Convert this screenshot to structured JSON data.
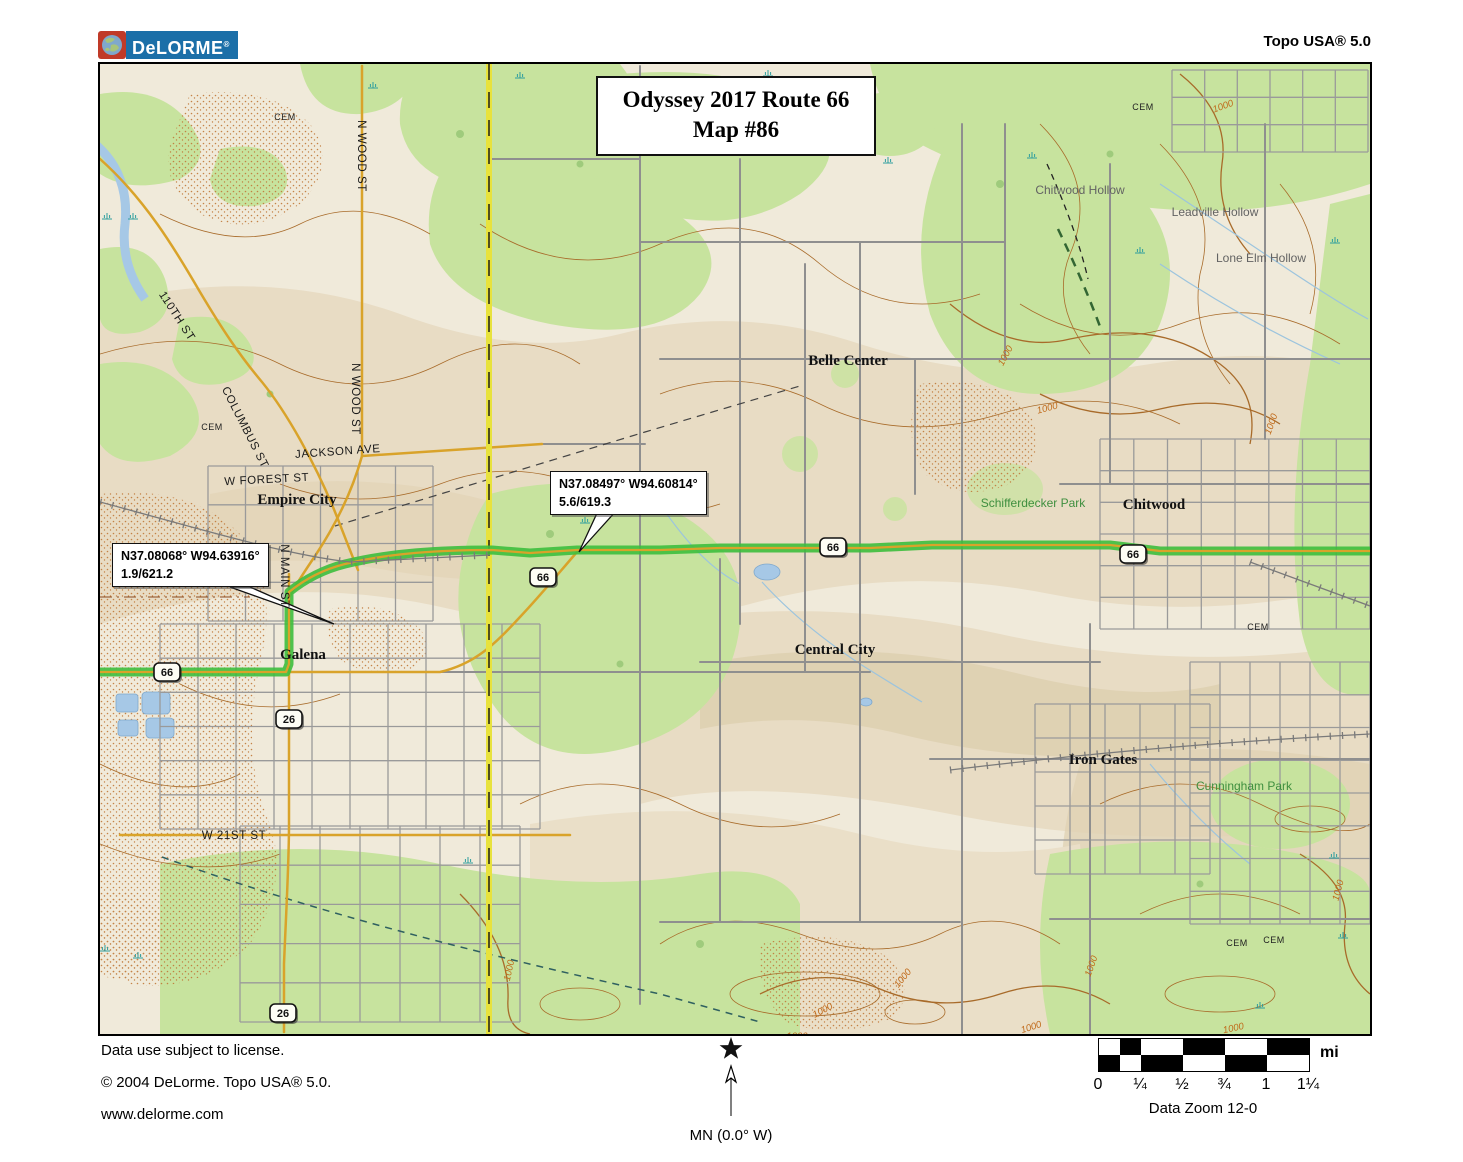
{
  "header": {
    "logo_text": "DeLORME",
    "logo_reg": "®",
    "product": "Topo USA® 5.0"
  },
  "map": {
    "title_line1": "Odyssey 2017 Route 66",
    "title_line2": "Map #86",
    "waypoints": [
      {
        "line1": "N37.08068° W94.63916°",
        "line2": "1.9/621.2"
      },
      {
        "line1": "N37.08497° W94.60814°",
        "line2": "5.6/619.3"
      }
    ],
    "shields": [
      {
        "text": "66",
        "x": 67,
        "y": 608
      },
      {
        "text": "66",
        "x": 443,
        "y": 513
      },
      {
        "text": "66",
        "x": 733,
        "y": 483
      },
      {
        "text": "66",
        "x": 1033,
        "y": 490
      },
      {
        "text": "26",
        "x": 189,
        "y": 655
      },
      {
        "text": "26",
        "x": 183,
        "y": 949
      }
    ],
    "labels": [
      {
        "text": "Empire City",
        "x": 197,
        "y": 440,
        "cls": "city"
      },
      {
        "text": "Galena",
        "x": 203,
        "y": 595,
        "cls": "city"
      },
      {
        "text": "Belle Center",
        "x": 748,
        "y": 301,
        "cls": "city"
      },
      {
        "text": "Central City",
        "x": 735,
        "y": 590,
        "cls": "city"
      },
      {
        "text": "Chitwood",
        "x": 1054,
        "y": 445,
        "cls": "city"
      },
      {
        "text": "Iron Gates",
        "x": 1003,
        "y": 700,
        "cls": "city"
      },
      {
        "text": "Schifferdecker Park",
        "x": 933,
        "y": 443,
        "cls": "park"
      },
      {
        "text": "Cunningham Park",
        "x": 1144,
        "y": 726,
        "cls": "park"
      },
      {
        "text": "Chitwood Hollow",
        "x": 980,
        "y": 130,
        "cls": "hollow"
      },
      {
        "text": "Leadville Hollow",
        "x": 1115,
        "y": 152,
        "cls": "hollow"
      },
      {
        "text": "Lone Elm Hollow",
        "x": 1161,
        "y": 198,
        "cls": "hollow"
      },
      {
        "text": "JACKSON AVE",
        "x": 238,
        "y": 391,
        "cls": "street",
        "rot": -4
      },
      {
        "text": "W FOREST ST",
        "x": 167,
        "y": 419,
        "cls": "street",
        "rot": -3
      },
      {
        "text": "110TH ST",
        "x": 74,
        "y": 254,
        "cls": "street",
        "rot": 57
      },
      {
        "text": "COLUMBUS ST",
        "x": 142,
        "y": 365,
        "cls": "street",
        "rot": 63
      },
      {
        "text": "N WOOD ST",
        "x": 258,
        "y": 92,
        "cls": "street",
        "rot": 90
      },
      {
        "text": "N WOOD ST",
        "x": 252,
        "y": 335,
        "cls": "street",
        "rot": 90
      },
      {
        "text": "N MAIN ST",
        "x": 181,
        "y": 512,
        "cls": "street",
        "rot": 90
      },
      {
        "text": "W 21ST ST",
        "x": 134,
        "y": 775,
        "cls": "street"
      },
      {
        "text": "CEM",
        "x": 112,
        "y": 366,
        "cls": "cem"
      },
      {
        "text": "CEM",
        "x": 185,
        "y": 56,
        "cls": "cem"
      },
      {
        "text": "CEM",
        "x": 1043,
        "y": 46,
        "cls": "cem"
      },
      {
        "text": "CEM",
        "x": 1158,
        "y": 566,
        "cls": "cem"
      },
      {
        "text": "CEM",
        "x": 1137,
        "y": 882,
        "cls": "cem"
      },
      {
        "text": "CEM",
        "x": 1174,
        "y": 879,
        "cls": "cem"
      },
      {
        "text": "1000",
        "x": 908,
        "y": 293,
        "cls": "contour",
        "rot": -62
      },
      {
        "text": "1000",
        "x": 948,
        "y": 347,
        "cls": "contour",
        "rot": -15
      },
      {
        "text": "1000",
        "x": 1174,
        "y": 361,
        "cls": "contour",
        "rot": -70
      },
      {
        "text": "1000",
        "x": 1124,
        "y": 45,
        "cls": "contour",
        "rot": -20
      },
      {
        "text": "1000",
        "x": 724,
        "y": 949,
        "cls": "contour",
        "rot": -28
      },
      {
        "text": "1000",
        "x": 994,
        "y": 903,
        "cls": "contour",
        "rot": -70
      },
      {
        "text": "1000",
        "x": 1134,
        "y": 967,
        "cls": "contour",
        "rot": -12
      },
      {
        "text": "1000",
        "x": 412,
        "y": 907,
        "cls": "contour",
        "rot": -78
      },
      {
        "text": "1000",
        "x": 1241,
        "y": 827,
        "cls": "contour",
        "rot": -75
      },
      {
        "text": "1000",
        "x": 805,
        "y": 916,
        "cls": "contour",
        "rot": -50
      },
      {
        "text": "1000",
        "x": 932,
        "y": 966,
        "cls": "contour",
        "rot": -18
      },
      {
        "text": "1000",
        "x": 697,
        "y": 975,
        "cls": "contour"
      }
    ]
  },
  "footer": {
    "license": "Data use subject to license.",
    "copyright": "© 2004 DeLorme. Topo USA® 5.0.",
    "website": "www.delorme.com",
    "compass_label": "MN (0.0° W)",
    "scale": {
      "ticks": [
        "0",
        "¼",
        "½",
        "¾",
        "1",
        "1¼"
      ],
      "unit": "mi",
      "zoom": "Data Zoom 12-0"
    }
  },
  "colors": {
    "route_highlight_green": "#3DBE3D",
    "road_gold": "#D9A32A",
    "county_line_yellow": "#E8E23C",
    "water_blue": "#A6C8E6",
    "vegetation_green": "#C7E39E",
    "contour_brown": "#A86B2A",
    "logo_blue": "#1B6FA8",
    "logo_red": "#C03A28"
  }
}
